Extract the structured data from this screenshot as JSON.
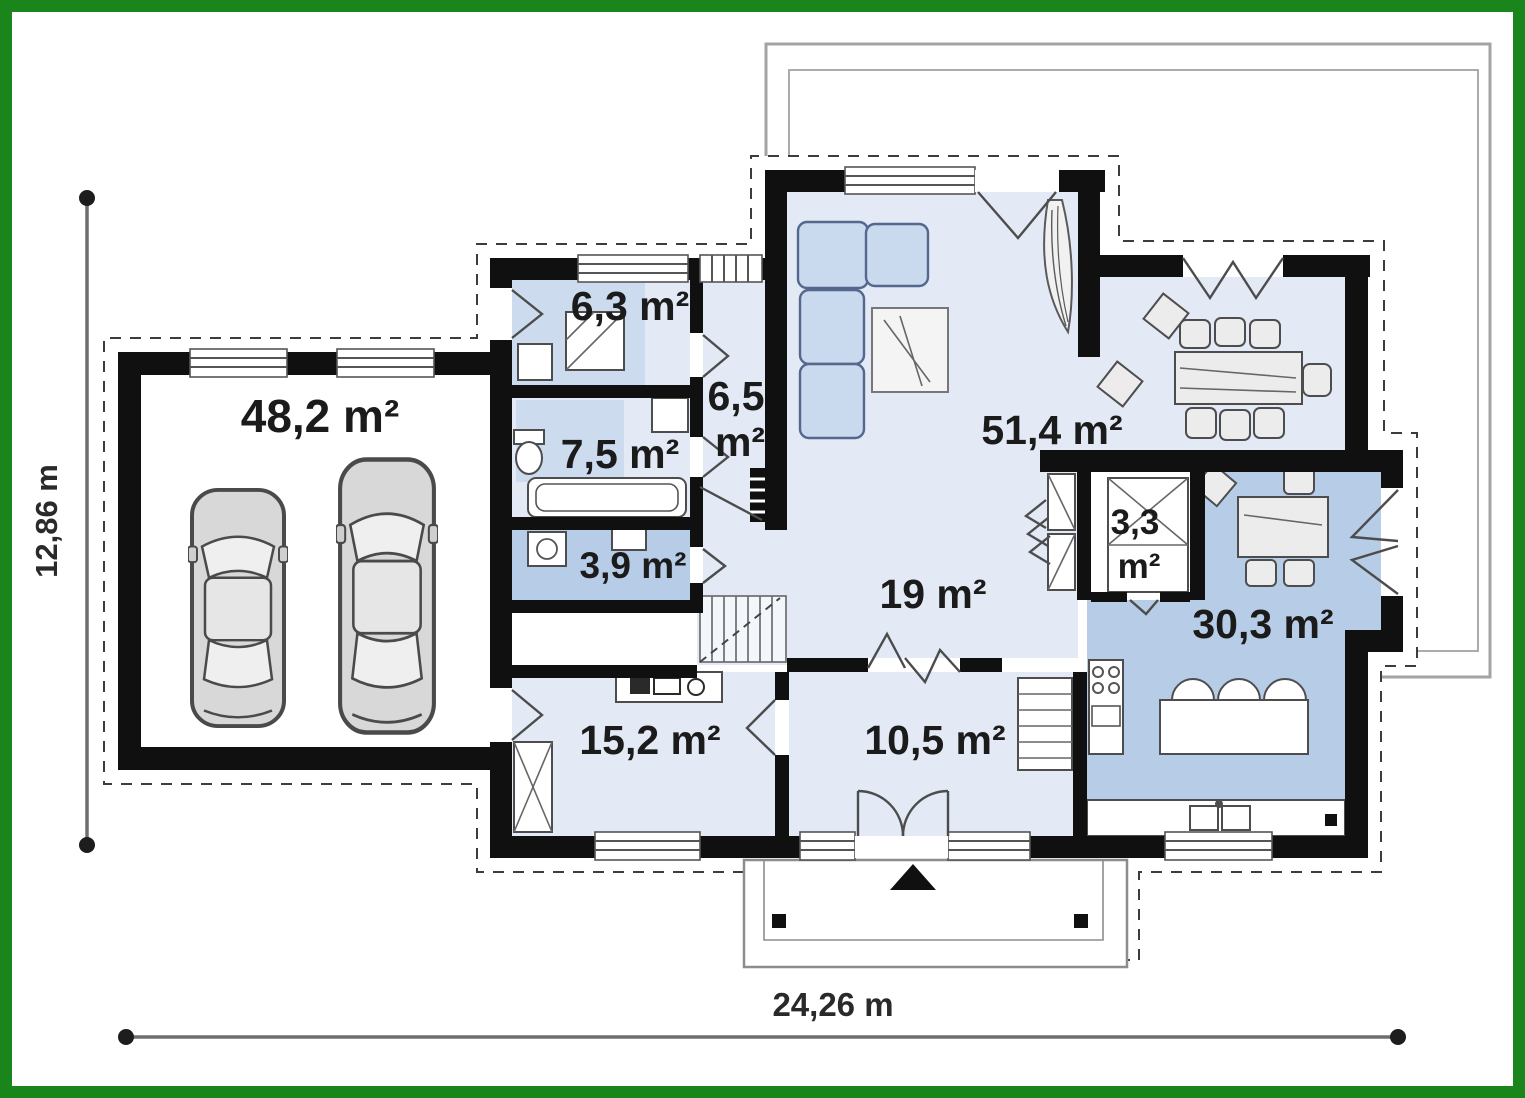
{
  "frame": {
    "border_color": "#1a851a"
  },
  "plan": {
    "dimensions": {
      "width_label": "24,26 m",
      "height_label": "12,86 m"
    },
    "rooms": {
      "garage": "48,2 m²",
      "mudroom": "6,3 m²",
      "bathroom": "7,5 m²",
      "corridor_value": "6,5",
      "corridor_unit": "m²",
      "laundry": "3,9 m²",
      "bedroom": "15,2 m²",
      "hall": "19 m²",
      "vestibule": "10,5 m²",
      "living_room": "51,4 m²",
      "pantry_value": "3,3",
      "pantry_unit": "m²",
      "kitchen": "30,3 m²"
    },
    "colors": {
      "room_light": "#e3eaf6",
      "room_medium": "#ccdcee",
      "room_dark": "#b7cce6",
      "wall": "#101010",
      "frame_green": "#1a851a"
    }
  }
}
